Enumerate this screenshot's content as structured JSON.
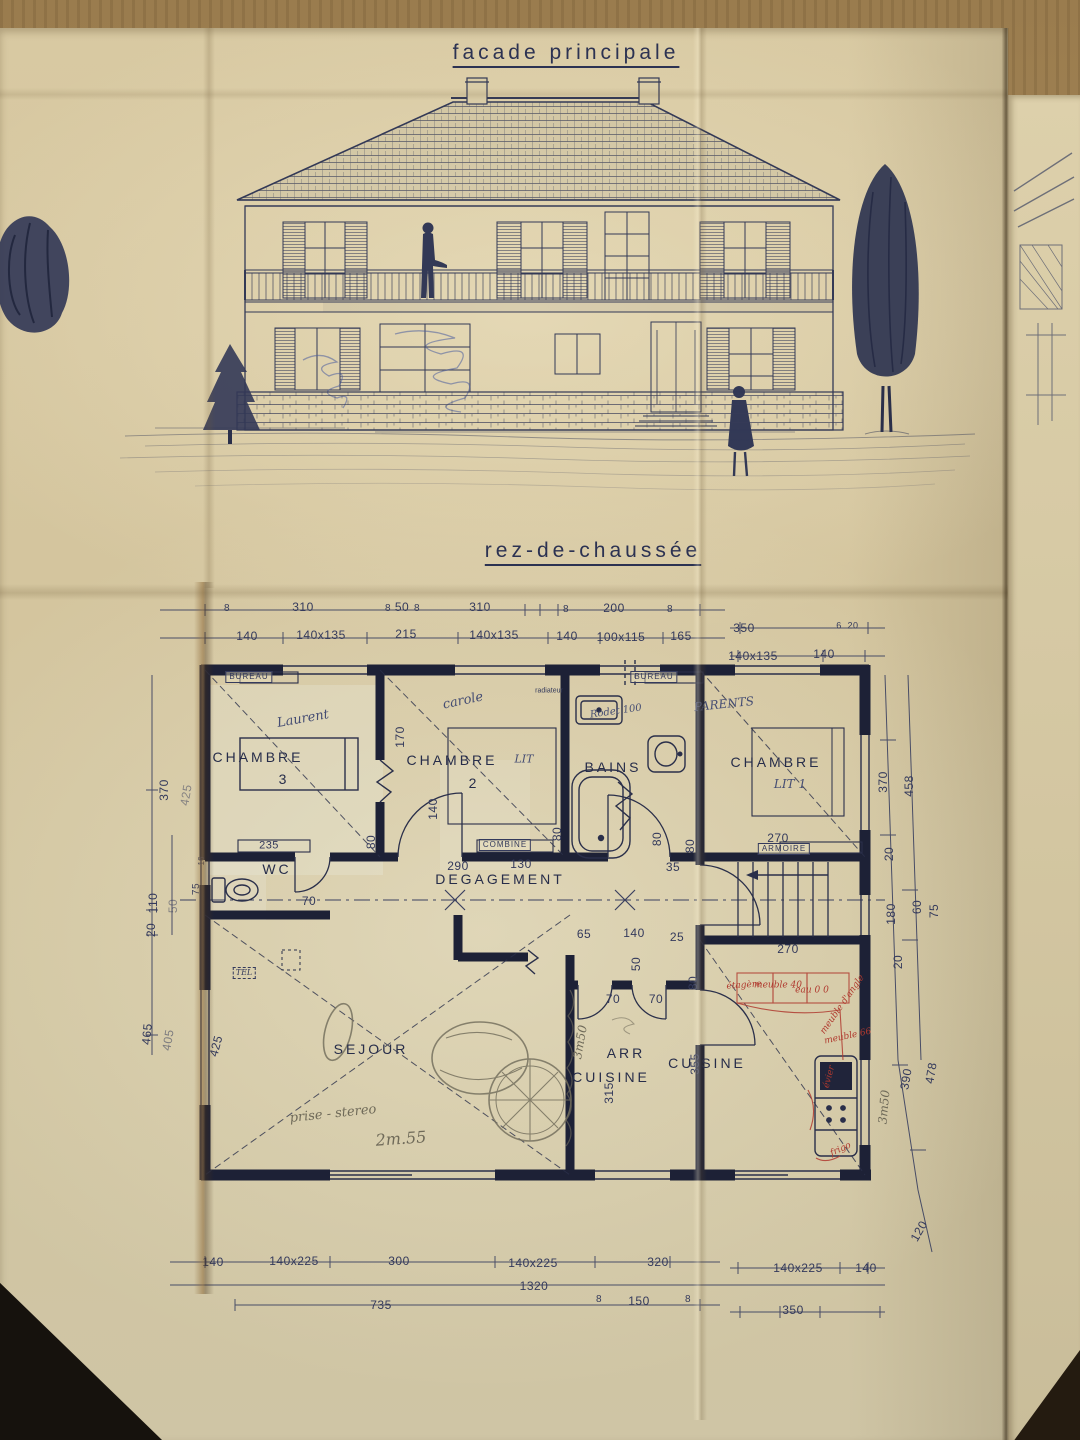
{
  "titles": {
    "facade": "facade principale",
    "plan": "rez-de-chaussée"
  },
  "ink_color": "#333956",
  "wall_color": "#1d2136",
  "red_ink_color": "#b03a2f",
  "plan": {
    "labels": [
      {
        "k": "d",
        "t": "8",
        "x": 227,
        "y": 609,
        "s": 10
      },
      {
        "k": "d",
        "t": "310",
        "x": 303,
        "y": 607
      },
      {
        "k": "d",
        "t": "8",
        "x": 388,
        "y": 609,
        "s": 10
      },
      {
        "k": "d",
        "t": "50",
        "x": 402,
        "y": 607
      },
      {
        "k": "d",
        "t": "8",
        "x": 417,
        "y": 609,
        "s": 10
      },
      {
        "k": "d",
        "t": "310",
        "x": 480,
        "y": 607
      },
      {
        "k": "d",
        "t": "8",
        "x": 566,
        "y": 610,
        "s": 10
      },
      {
        "k": "d",
        "t": "200",
        "x": 614,
        "y": 608
      },
      {
        "k": "d",
        "t": "8",
        "x": 670,
        "y": 610,
        "s": 10
      },
      {
        "k": "d",
        "t": "350",
        "x": 744,
        "y": 628
      },
      {
        "k": "d",
        "t": "6",
        "x": 839,
        "y": 626,
        "s": 9
      },
      {
        "k": "d",
        "t": "20",
        "x": 853,
        "y": 626,
        "s": 9
      },
      {
        "k": "d",
        "t": "140",
        "x": 247,
        "y": 636
      },
      {
        "k": "d",
        "t": "140x135",
        "x": 321,
        "y": 635
      },
      {
        "k": "d",
        "t": "215",
        "x": 406,
        "y": 634
      },
      {
        "k": "d",
        "t": "140x135",
        "x": 494,
        "y": 635
      },
      {
        "k": "d",
        "t": "140",
        "x": 567,
        "y": 636
      },
      {
        "k": "d",
        "t": "100x115",
        "x": 621,
        "y": 637
      },
      {
        "k": "d",
        "t": "165",
        "x": 681,
        "y": 636
      },
      {
        "k": "d",
        "t": "140x135",
        "x": 753,
        "y": 656
      },
      {
        "k": "d",
        "t": "140",
        "x": 824,
        "y": 654
      },
      {
        "k": "d",
        "t": "370",
        "x": 164,
        "y": 790,
        "r": -90
      },
      {
        "k": "d",
        "t": "425",
        "x": 186,
        "y": 795,
        "r": -80,
        "o": 0.5
      },
      {
        "k": "d",
        "t": "110",
        "x": 153,
        "y": 903,
        "r": -90
      },
      {
        "k": "d",
        "t": "50",
        "x": 173,
        "y": 906,
        "r": -90,
        "o": 0.5
      },
      {
        "k": "d",
        "t": "75",
        "x": 197,
        "y": 889,
        "r": -90,
        "s": 10
      },
      {
        "k": "tn",
        "t": "16",
        "x": 202,
        "y": 861,
        "r": -90,
        "s": 8
      },
      {
        "k": "d",
        "t": "20",
        "x": 151,
        "y": 930,
        "r": -90
      },
      {
        "k": "d",
        "t": "465",
        "x": 147,
        "y": 1034,
        "r": -85
      },
      {
        "k": "d",
        "t": "405",
        "x": 168,
        "y": 1040,
        "r": -80,
        "o": 0.55
      },
      {
        "k": "d",
        "t": "425",
        "x": 216,
        "y": 1046,
        "r": -75
      },
      {
        "k": "d",
        "t": "370",
        "x": 883,
        "y": 782,
        "r": -90
      },
      {
        "k": "d",
        "t": "458",
        "x": 909,
        "y": 786,
        "r": -90
      },
      {
        "k": "d",
        "t": "20",
        "x": 889,
        "y": 854,
        "r": -90
      },
      {
        "k": "d",
        "t": "180",
        "x": 891,
        "y": 914,
        "r": -90
      },
      {
        "k": "d",
        "t": "60",
        "x": 917,
        "y": 907,
        "r": -90
      },
      {
        "k": "d",
        "t": "75",
        "x": 934,
        "y": 911,
        "r": -90
      },
      {
        "k": "d",
        "t": "20",
        "x": 898,
        "y": 962,
        "r": -90
      },
      {
        "k": "d",
        "t": "390",
        "x": 906,
        "y": 1079,
        "r": -80
      },
      {
        "k": "d",
        "t": "478",
        "x": 931,
        "y": 1073,
        "r": -80
      },
      {
        "k": "d",
        "t": "120",
        "x": 919,
        "y": 1231,
        "r": -60
      },
      {
        "k": "d",
        "t": "170",
        "x": 400,
        "y": 737,
        "r": -90
      },
      {
        "k": "d",
        "t": "140",
        "x": 433,
        "y": 809,
        "r": -90
      },
      {
        "k": "d",
        "t": "80",
        "x": 371,
        "y": 842,
        "r": -90
      },
      {
        "k": "d",
        "t": "80",
        "x": 557,
        "y": 834,
        "r": -90
      },
      {
        "k": "d",
        "t": "80",
        "x": 657,
        "y": 839,
        "r": -90
      },
      {
        "k": "d",
        "t": "80",
        "x": 690,
        "y": 846,
        "r": -90
      },
      {
        "k": "d",
        "t": "70",
        "x": 309,
        "y": 901
      },
      {
        "k": "d",
        "t": "235",
        "x": 269,
        "y": 846,
        "s": 11
      },
      {
        "k": "d",
        "t": "290",
        "x": 458,
        "y": 866
      },
      {
        "k": "d",
        "t": "130",
        "x": 521,
        "y": 864
      },
      {
        "k": "d",
        "t": "35",
        "x": 673,
        "y": 867
      },
      {
        "k": "d",
        "t": "270",
        "x": 778,
        "y": 838
      },
      {
        "k": "d",
        "t": "270",
        "x": 788,
        "y": 949
      },
      {
        "k": "d",
        "t": "65",
        "x": 584,
        "y": 934
      },
      {
        "k": "d",
        "t": "140",
        "x": 634,
        "y": 933
      },
      {
        "k": "d",
        "t": "25",
        "x": 677,
        "y": 937
      },
      {
        "k": "d",
        "t": "50",
        "x": 636,
        "y": 964,
        "r": -90
      },
      {
        "k": "d",
        "t": "70",
        "x": 613,
        "y": 999
      },
      {
        "k": "d",
        "t": "70",
        "x": 656,
        "y": 999
      },
      {
        "k": "d",
        "t": "80",
        "x": 693,
        "y": 983,
        "r": -90
      },
      {
        "k": "d",
        "t": "315",
        "x": 609,
        "y": 1093,
        "r": -90
      },
      {
        "k": "d",
        "t": "355",
        "x": 695,
        "y": 1064,
        "r": -90
      },
      {
        "k": "d",
        "t": "140",
        "x": 213,
        "y": 1262
      },
      {
        "k": "d",
        "t": "140x225",
        "x": 294,
        "y": 1261
      },
      {
        "k": "d",
        "t": "300",
        "x": 399,
        "y": 1261
      },
      {
        "k": "d",
        "t": "140x225",
        "x": 533,
        "y": 1263
      },
      {
        "k": "d",
        "t": "320",
        "x": 658,
        "y": 1262
      },
      {
        "k": "d",
        "t": "140x225",
        "x": 798,
        "y": 1268
      },
      {
        "k": "d",
        "t": "140",
        "x": 866,
        "y": 1268
      },
      {
        "k": "d",
        "t": "1320",
        "x": 534,
        "y": 1286
      },
      {
        "k": "d",
        "t": "735",
        "x": 381,
        "y": 1305
      },
      {
        "k": "d",
        "t": "8",
        "x": 599,
        "y": 1300,
        "s": 10
      },
      {
        "k": "d",
        "t": "150",
        "x": 639,
        "y": 1301
      },
      {
        "k": "d",
        "t": "8",
        "x": 688,
        "y": 1300,
        "s": 10
      },
      {
        "k": "d",
        "t": "350",
        "x": 793,
        "y": 1310
      },
      {
        "k": "rm",
        "t": "CHAMBRE",
        "x": 258,
        "y": 757
      },
      {
        "k": "rm",
        "t": "3",
        "x": 284,
        "y": 779
      },
      {
        "k": "rm",
        "t": "CHAMBRE",
        "x": 452,
        "y": 760
      },
      {
        "k": "rm",
        "t": "2",
        "x": 474,
        "y": 783
      },
      {
        "k": "rm",
        "t": "BAINS",
        "x": 613,
        "y": 767
      },
      {
        "k": "rm",
        "t": "CHAMBRE",
        "x": 776,
        "y": 762
      },
      {
        "k": "rm",
        "t": "WC",
        "x": 277,
        "y": 869
      },
      {
        "k": "rm",
        "t": "DEGAGEMENT",
        "x": 500,
        "y": 879
      },
      {
        "k": "rm",
        "t": "SEJOUR",
        "x": 371,
        "y": 1049
      },
      {
        "k": "rm",
        "t": "ARR",
        "x": 626,
        "y": 1053
      },
      {
        "k": "rm",
        "t": "CUISINE",
        "x": 611,
        "y": 1077
      },
      {
        "k": "rm",
        "t": "CUISINE",
        "x": 707,
        "y": 1063
      },
      {
        "k": "hb",
        "t": "Laurent",
        "x": 303,
        "y": 719,
        "r": -10
      },
      {
        "k": "hb",
        "t": "carole",
        "x": 463,
        "y": 701,
        "r": -12
      },
      {
        "k": "hb",
        "t": "PARENTS",
        "x": 724,
        "y": 704,
        "r": -6,
        "s": 12
      },
      {
        "k": "hb",
        "t": "LIT",
        "x": 524,
        "y": 759,
        "s": 11
      },
      {
        "k": "hb",
        "t": "LIT 1",
        "x": 790,
        "y": 784,
        "s": 12
      },
      {
        "k": "hb",
        "t": "Rodet 100",
        "x": 616,
        "y": 712,
        "r": -8,
        "s": 10
      },
      {
        "k": "bx",
        "t": "BUREAU",
        "x": 249,
        "y": 677
      },
      {
        "k": "bx",
        "t": "BUREAU",
        "x": 654,
        "y": 677
      },
      {
        "k": "bx",
        "t": "ARMOIRE",
        "x": 784,
        "y": 849
      },
      {
        "k": "bx",
        "t": "COMBINE",
        "x": 505,
        "y": 845
      },
      {
        "k": "bd",
        "t": "TEL",
        "x": 244,
        "y": 973
      },
      {
        "k": "tn",
        "t": "radiateur",
        "x": 549,
        "y": 691
      },
      {
        "k": "hp",
        "t": "prise - stereo",
        "x": 333,
        "y": 1114,
        "r": -6
      },
      {
        "k": "hp",
        "t": "2m.55",
        "x": 401,
        "y": 1139,
        "r": -4,
        "s": 16
      },
      {
        "k": "hp",
        "t": "3m50",
        "x": 580,
        "y": 1042,
        "r": -80,
        "s": 12
      },
      {
        "k": "hp",
        "t": "3m50",
        "x": 884,
        "y": 1107,
        "r": -85,
        "s": 12
      },
      {
        "k": "hr",
        "t": "étagère",
        "x": 744,
        "y": 986,
        "r": -4
      },
      {
        "k": "hr",
        "t": "meuble 40",
        "x": 778,
        "y": 986
      },
      {
        "k": "hr",
        "t": "eau 0 0",
        "x": 812,
        "y": 991
      },
      {
        "k": "hr",
        "t": "meuble d'angle",
        "x": 843,
        "y": 1005,
        "r": -55
      },
      {
        "k": "hr",
        "t": "meuble 66",
        "x": 848,
        "y": 1037,
        "r": -12
      },
      {
        "k": "hr",
        "t": "évier",
        "x": 830,
        "y": 1077,
        "r": -75
      },
      {
        "k": "hr",
        "t": "frigo",
        "x": 841,
        "y": 1150,
        "r": -25
      }
    ]
  }
}
